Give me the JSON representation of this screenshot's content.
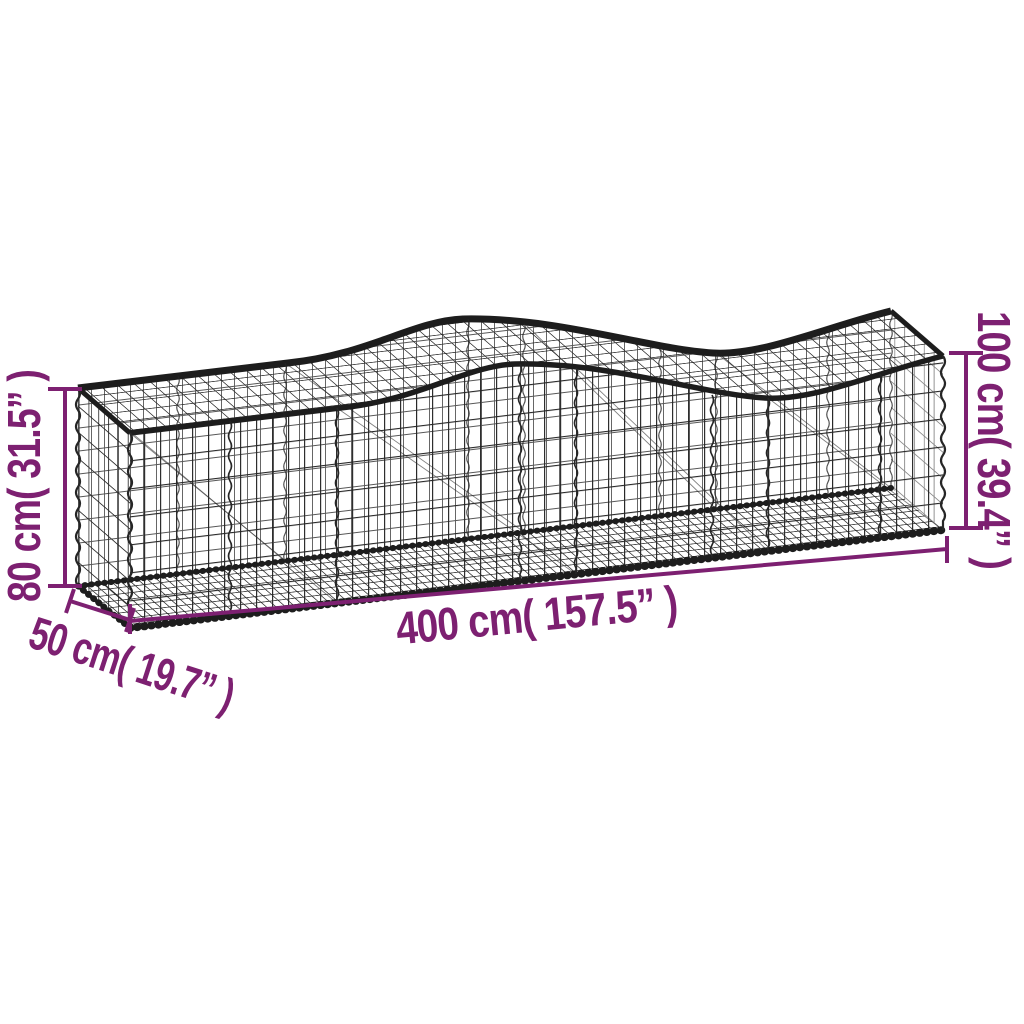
{
  "diagram": {
    "annotation_color": "#7d2071",
    "wire_color": "#262626",
    "background_color": "#ffffff",
    "labels": {
      "height_left": "80 cm( 31.5” )",
      "height_right": "100 cm( 39.4” )",
      "length": "400 cm( 157.5” )",
      "depth": "50 cm( 19.7” )"
    }
  }
}
